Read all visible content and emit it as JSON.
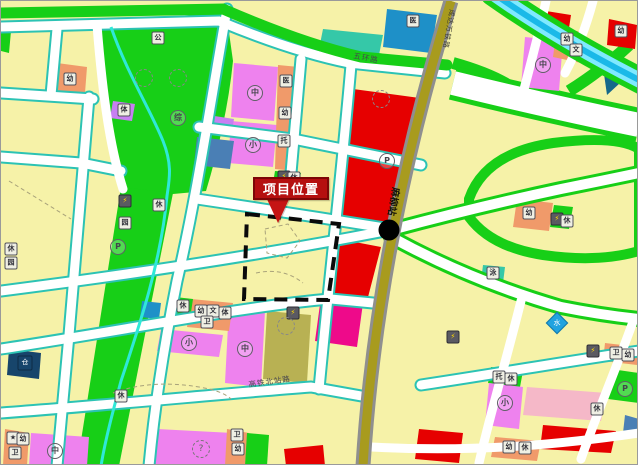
{
  "colors": {
    "parcel_yellow": "#f6f2a8",
    "park_green": "#17cf17",
    "teal_edge": "#2cc3b4",
    "stream_cyan": "#2fe8d8",
    "commercial_red": "#e60000",
    "school_pink": "#ee82ee",
    "light_pink": "#f5b8c8",
    "magenta": "#ee0a8a",
    "orange": "#f09a6a",
    "blue": "#1e90c8",
    "steel_blue": "#4a7fb5",
    "dark_teal": "#16698a",
    "navy": "#17456b",
    "purple": "#c77ff2",
    "khaki": "#b8b153",
    "railway_olive": "#a89b1e",
    "railway_gray": "#8f8f8f",
    "river_blue": "#1ab9e8",
    "river_light": "#7fe9ff",
    "callout_red": "#b50f0f",
    "station_black": "#000000"
  },
  "map": {
    "callout_label": "项目位置",
    "station_name": "麻柳站",
    "road_labels": [
      {
        "text": "五环路"
      },
      {
        "text": "成达万铁路"
      },
      {
        "text": "高铁北站路"
      }
    ],
    "markers": [
      {
        "glyph": "幼",
        "x": 69,
        "y": 78,
        "kind": "box",
        "name": "kindergarten-marker"
      },
      {
        "glyph": "公",
        "x": 157,
        "y": 37,
        "kind": "box",
        "name": "public-facility-marker"
      },
      {
        "glyph": "体",
        "x": 123,
        "y": 109,
        "kind": "box",
        "name": "sports-facility-marker"
      },
      {
        "glyph": "⚡",
        "x": 124,
        "y": 200,
        "kind": "power",
        "name": "power-facility-marker"
      },
      {
        "glyph": "休",
        "x": 158,
        "y": 204,
        "kind": "box",
        "name": "leisure-marker"
      },
      {
        "glyph": "园",
        "x": 124,
        "y": 222,
        "kind": "box",
        "name": "garden-marker"
      },
      {
        "glyph": "综",
        "x": 177,
        "y": 117,
        "kind": "circle",
        "name": "mixed-use-marker"
      },
      {
        "glyph": "中",
        "x": 254,
        "y": 92,
        "kind": "circle",
        "name": "middle-school-marker"
      },
      {
        "glyph": "小",
        "x": 252,
        "y": 144,
        "kind": "circle",
        "name": "primary-school-marker"
      },
      {
        "glyph": "医",
        "x": 285,
        "y": 80,
        "kind": "box",
        "name": "clinic-marker"
      },
      {
        "glyph": "幼",
        "x": 284,
        "y": 112,
        "kind": "box",
        "name": "kindergarten-marker"
      },
      {
        "glyph": "托",
        "x": 283,
        "y": 140,
        "kind": "box",
        "name": "nursery-marker"
      },
      {
        "glyph": "⚡",
        "x": 283,
        "y": 176,
        "kind": "power",
        "name": "power-facility-marker"
      },
      {
        "glyph": "休",
        "x": 293,
        "y": 177,
        "kind": "box",
        "name": "leisure-marker"
      },
      {
        "glyph": "医",
        "x": 412,
        "y": 20,
        "kind": "box",
        "name": "hospital-marker"
      },
      {
        "glyph": "P",
        "x": 386,
        "y": 160,
        "kind": "circle",
        "name": "parking-marker"
      },
      {
        "glyph": "P",
        "x": 117,
        "y": 246,
        "kind": "circle",
        "name": "parking-marker"
      },
      {
        "glyph": "幼",
        "x": 566,
        "y": 38,
        "kind": "box",
        "name": "kindergarten-marker"
      },
      {
        "glyph": "文",
        "x": 575,
        "y": 49,
        "kind": "box",
        "name": "culture-marker"
      },
      {
        "glyph": "中",
        "x": 542,
        "y": 64,
        "kind": "circle",
        "name": "middle-school-marker"
      },
      {
        "glyph": "幼",
        "x": 620,
        "y": 30,
        "kind": "box",
        "name": "kindergarten-marker"
      },
      {
        "glyph": "幼",
        "x": 528,
        "y": 212,
        "kind": "box",
        "name": "kindergarten-marker"
      },
      {
        "glyph": "⚡",
        "x": 556,
        "y": 218,
        "kind": "power",
        "name": "power-facility-marker"
      },
      {
        "glyph": "休",
        "x": 566,
        "y": 220,
        "kind": "box",
        "name": "leisure-marker"
      },
      {
        "glyph": "泳",
        "x": 492,
        "y": 272,
        "kind": "box",
        "name": "swimming-marker"
      },
      {
        "glyph": "水",
        "x": 556,
        "y": 322,
        "kind": "diamond",
        "name": "water-facility-marker"
      },
      {
        "glyph": "⚡",
        "x": 452,
        "y": 336,
        "kind": "power",
        "name": "power-facility-marker"
      },
      {
        "glyph": "⚡",
        "x": 592,
        "y": 350,
        "kind": "power",
        "name": "power-facility-marker"
      },
      {
        "glyph": "卫",
        "x": 615,
        "y": 352,
        "kind": "box",
        "name": "health-marker"
      },
      {
        "glyph": "幼",
        "x": 627,
        "y": 354,
        "kind": "box",
        "name": "kindergarten-marker"
      },
      {
        "glyph": "托",
        "x": 498,
        "y": 376,
        "kind": "box",
        "name": "nursery-marker"
      },
      {
        "glyph": "休",
        "x": 510,
        "y": 378,
        "kind": "box",
        "name": "leisure-marker"
      },
      {
        "glyph": "小",
        "x": 504,
        "y": 402,
        "kind": "circle",
        "name": "primary-school-marker"
      },
      {
        "glyph": "休",
        "x": 596,
        "y": 408,
        "kind": "box",
        "name": "leisure-marker"
      },
      {
        "glyph": "P",
        "x": 624,
        "y": 388,
        "kind": "circle",
        "name": "parking-marker"
      },
      {
        "glyph": "幼",
        "x": 508,
        "y": 446,
        "kind": "box",
        "name": "kindergarten-marker"
      },
      {
        "glyph": "休",
        "x": 524,
        "y": 447,
        "kind": "box",
        "name": "leisure-marker"
      },
      {
        "glyph": "⚡",
        "x": 292,
        "y": 312,
        "kind": "power",
        "name": "power-facility-marker"
      },
      {
        "glyph": "幼",
        "x": 200,
        "y": 310,
        "kind": "box",
        "name": "kindergarten-marker"
      },
      {
        "glyph": "文",
        "x": 212,
        "y": 310,
        "kind": "box",
        "name": "culture-marker"
      },
      {
        "glyph": "体",
        "x": 224,
        "y": 312,
        "kind": "box",
        "name": "sports-facility-marker"
      },
      {
        "glyph": "卫",
        "x": 206,
        "y": 321,
        "kind": "box",
        "name": "health-marker"
      },
      {
        "glyph": "休",
        "x": 182,
        "y": 305,
        "kind": "box",
        "name": "leisure-marker"
      },
      {
        "glyph": "小",
        "x": 188,
        "y": 342,
        "kind": "circle",
        "name": "primary-school-marker"
      },
      {
        "glyph": "中",
        "x": 244,
        "y": 348,
        "kind": "circle",
        "name": "middle-school-marker"
      },
      {
        "glyph": "仓",
        "x": 24,
        "y": 362,
        "kind": "navy",
        "name": "warehouse-marker"
      },
      {
        "glyph": "休",
        "x": 10,
        "y": 248,
        "kind": "box",
        "name": "leisure-marker"
      },
      {
        "glyph": "园",
        "x": 10,
        "y": 262,
        "kind": "box",
        "name": "garden-marker"
      },
      {
        "glyph": "休",
        "x": 120,
        "y": 395,
        "kind": "box",
        "name": "leisure-marker"
      },
      {
        "glyph": "★",
        "x": 12,
        "y": 437,
        "kind": "box",
        "name": "landmark-marker"
      },
      {
        "glyph": "幼",
        "x": 22,
        "y": 438,
        "kind": "box",
        "name": "kindergarten-marker"
      },
      {
        "glyph": "卫",
        "x": 14,
        "y": 452,
        "kind": "box",
        "name": "health-marker"
      },
      {
        "glyph": "中",
        "x": 54,
        "y": 450,
        "kind": "circle",
        "name": "middle-school-marker"
      },
      {
        "glyph": "?",
        "x": 200,
        "y": 448,
        "kind": "qcircle",
        "name": "undetermined-parcel-marker"
      },
      {
        "glyph": "幼",
        "x": 237,
        "y": 448,
        "kind": "box",
        "name": "kindergarten-marker"
      },
      {
        "glyph": "卫",
        "x": 236,
        "y": 434,
        "kind": "box",
        "name": "health-marker"
      },
      {
        "glyph": "",
        "x": 143,
        "y": 77,
        "kind": "deco",
        "name": "tree-symbol"
      },
      {
        "glyph": "",
        "x": 177,
        "y": 77,
        "kind": "deco",
        "name": "tree-symbol"
      },
      {
        "glyph": "",
        "x": 380,
        "y": 98,
        "kind": "deco",
        "name": "tree-symbol"
      },
      {
        "glyph": "",
        "x": 285,
        "y": 325,
        "kind": "deco",
        "name": "tree-symbol"
      }
    ]
  }
}
